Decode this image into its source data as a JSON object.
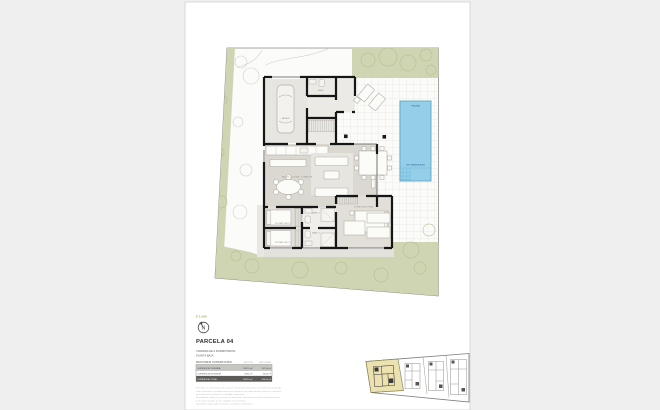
{
  "colors": {
    "canvas": "#efefef",
    "paper": "#ffffff",
    "garden_green": "#cfd5b2",
    "pool_blue": "#93cfe9",
    "wall_black": "#161616",
    "keyplan_highlight": "#ebe2b0",
    "scale_olive": "#a3a05e"
  },
  "info": {
    "scale": "E 1:100",
    "north": "N",
    "title": "PARCELA 04",
    "subtitle1": "VIVIENDA DE 3 DORMITORIOS.",
    "subtitle2": "PLANTA BAJA"
  },
  "table": {
    "title": "RESUMEN SUPERFICIES",
    "col_util": "SUP. ÚTIL",
    "col_const": "SUP. CONST.",
    "rows": [
      {
        "label": "SUPERFICIE VIVIENDA",
        "util": "138,70 m²",
        "cons": "167,00 m²"
      },
      {
        "label": "SUPERFICIE EXTERIOR",
        "util": "29,85 m²",
        "cons": "36,45 m²"
      },
      {
        "label": "SUPERFICIE TOTAL",
        "util": "168,55 m²",
        "cons": "203,45 m²"
      }
    ]
  },
  "disclaimer": {
    "lines": [
      "Este plano es orientativo y de carácter meramente informativo, no contractual, pudiendo",
      "sufrir variaciones y modificaciones por exigencias de orden técnico, jurídico o comercial",
      "de la dirección facultativa o autoridad competente.",
      "El mobiliario, jardinería y piscina son elementos decorativos a efectos de presentación",
      "y no están incluidos en las calidades de la vivienda.",
      "Superficies expresadas en metros cuadrados construidos."
    ]
  },
  "plan": {
    "rooms": {
      "garage": "GARAJE",
      "aseo": "ASEO",
      "living": "SALÓN · COCINA · COMEDOR",
      "bedroom1": "DORMITORIO 1",
      "bedroom2": "DORMITORIO 2",
      "master": "DORMITORIO PPAL.",
      "bath1": "BAÑO 1",
      "bath2": "BAÑO 2"
    },
    "pool": {
      "top": "PISCINA",
      "bottom": "SUP. LÁMINA DE AGUA"
    }
  }
}
